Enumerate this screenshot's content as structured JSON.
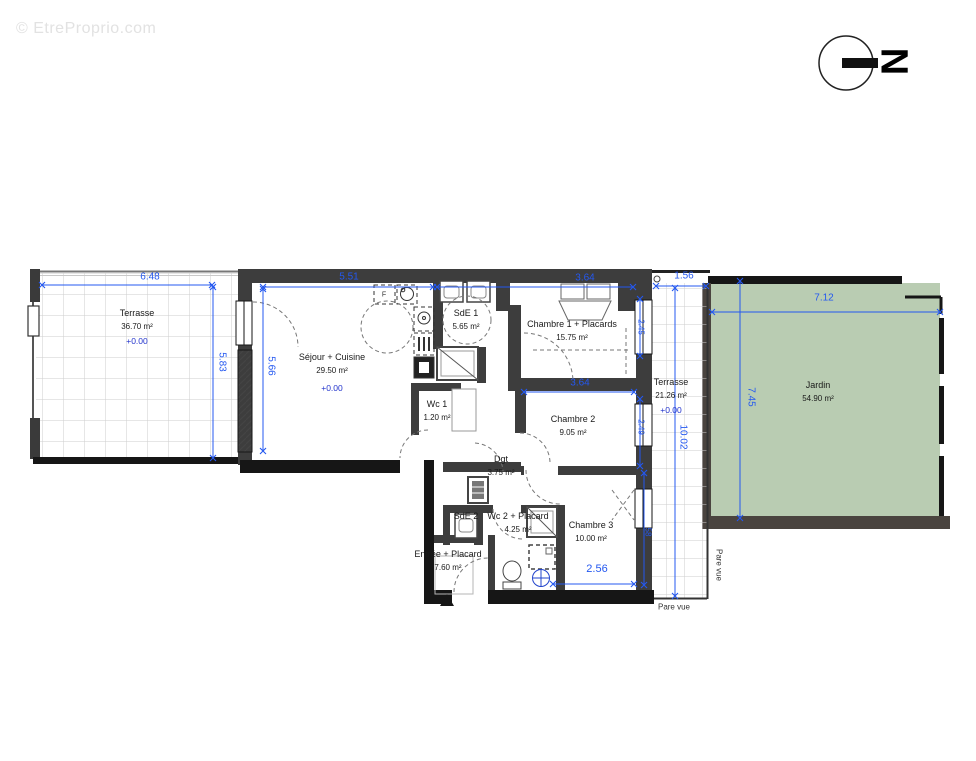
{
  "watermark": "© EtreProprio.com",
  "compass": {
    "letter": "N"
  },
  "rooms": [
    {
      "name": "Terrasse",
      "area": "36.70 m²",
      "level": "+0.00"
    },
    {
      "name": "Séjour + Cuisine",
      "area": "29.50 m²",
      "level": "+0.00"
    },
    {
      "name": "SdE 1",
      "area": "5.65 m²"
    },
    {
      "name": "Chambre 1 + Placards",
      "area": "15.75 m²"
    },
    {
      "name": "Wc 1",
      "area": "1.20 m²"
    },
    {
      "name": "Chambre 2",
      "area": "9.05 m²"
    },
    {
      "name": "Dgt",
      "area": "3.75 m²"
    },
    {
      "name": "SdE 2"
    },
    {
      "name": "Wc 2 + Placard",
      "area": "4.25 m²"
    },
    {
      "name": "Chambre 3",
      "area": "10.00 m²"
    },
    {
      "name": "Entrée + Placard",
      "area": "7.60 m²"
    },
    {
      "name": "Terrasse",
      "area": "21.26 m²",
      "level": "+0.00"
    },
    {
      "name": "Jardin",
      "area": "54.90 m²"
    }
  ],
  "dims": [
    {
      "value": "6.48"
    },
    {
      "value": "5.83"
    },
    {
      "value": "5.51"
    },
    {
      "value": "5.66"
    },
    {
      "value": "3.64"
    },
    {
      "value": "3.64"
    },
    {
      "value": "1.56"
    },
    {
      "value": "10.02"
    },
    {
      "value": "2.45"
    },
    {
      "value": "2.49"
    },
    {
      "value": "58"
    },
    {
      "value": "2.56"
    },
    {
      "value": "7.12"
    },
    {
      "value": "7.45"
    }
  ],
  "annotations": {
    "pare_vue_side": "Pare vue",
    "pare_vue_bottom": "Pare vue",
    "fridge": "F"
  },
  "colors": {
    "dimension": "#2458f0",
    "wall": "#3d3d3d",
    "wall_black": "#161616",
    "garden": "#b9ccb2",
    "level": "#2233cc"
  }
}
